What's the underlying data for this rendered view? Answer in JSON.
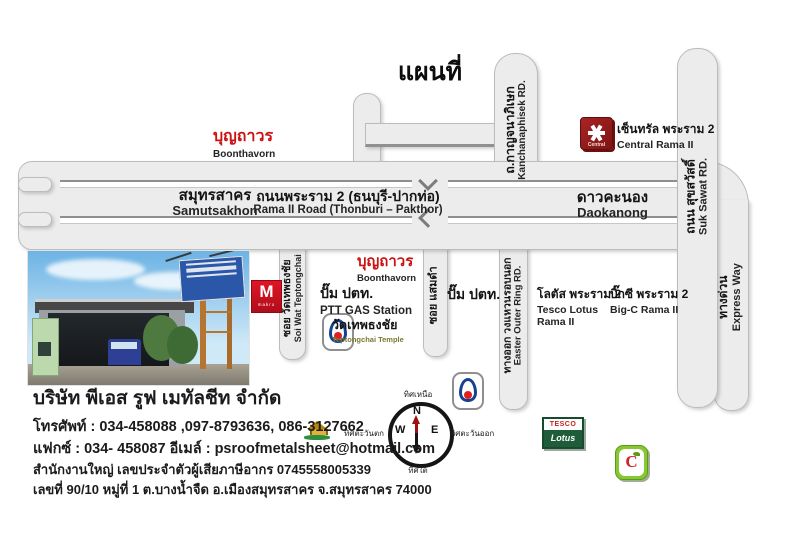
{
  "title": "แผนที่",
  "roads": {
    "samutsakhon_th": "สมุทรสาคร",
    "samutsakhon_en": "Samutsakhon",
    "rama2_th": "ถนนพระราม 2 (ธนบุรี-ปากท่อ)",
    "rama2_en": "Rama II Road (Thonburi – Pakthor)",
    "daokanong_th": "ดาวคะนอง",
    "daokanong_en": "Daokanong",
    "kanchanaphisek_th": "ถ.กาญจนาภิเษก",
    "kanchanaphisek_en": "Kanchanaphisek RD.",
    "suksawat_th": "ถนน สุขสวัสดิ์",
    "suksawat_en": "Suk Sawat RD.",
    "expressway_th": "ทางด่วน",
    "expressway_en": "Express Way",
    "outerring_th": "ทางออก วงแหวนรอบนอก",
    "outerring_en": "Easter Outer Ring RD.",
    "soi_wat_th": "ซอย วัดเทพธงชัย",
    "soi_wat_en": "Soi Wat Teptongchai",
    "soi_samaedam_th": "ซอย แสมดำ"
  },
  "pois": {
    "boonthavorn_top_th": "บุญถาวร",
    "boonthavorn_top_en": "Boonthavorn",
    "central_th": "เซ็นทรัล พระราม 2",
    "central_en": "Central Rama II",
    "central_logo": "Central",
    "makro_m": "M",
    "makro_word": "makro",
    "boonthavorn_mid_th": "บุญถาวร",
    "boonthavorn_mid_en": "Boonthavorn",
    "ptt1_th": "ปั๊ม ปตท.",
    "ptt1_en": "PTT GAS Station",
    "ptt2_th": "ปั๊ม ปตท.",
    "temple_th": "วัดเทพธงชัย",
    "temple_en": "Teptongchai Temple",
    "tesco_logo_top": "TESCO",
    "tesco_logo_bottom": "Lotus",
    "tesco_th": "โลตัส พระราม 2",
    "tesco_en1": "Tesco Lotus",
    "tesco_en2": "Rama II",
    "bigc_c": "C",
    "bigc_th": "บิ๊กซี พระราม 2",
    "bigc_en": "Big-C Rama II"
  },
  "compass": {
    "n": "N",
    "s": "S",
    "e": "E",
    "w": "W",
    "north_th": "ทิศเหนือ",
    "south_th": "ทิศใต้",
    "east_th": "ทิศตะวันออก",
    "west_th": "ทิศตะวันตก"
  },
  "company": {
    "name": "บริษัท พีเอส รูฟ เมทัลชีท จำกัด",
    "phone": "โทรศัพท์ : 034-458088 ,097-8793636, 086-3127662",
    "fax_email": "แฟกซ์ : 034- 458087   อีเมล์ : psroofmetalsheet@hotmail.com",
    "tax": "สำนักงานใหญ่ เลขประจำตัวผู้เสียภาษีอากร 0745558005339",
    "address": "เลขที่ 90/10 หมู่ที่ 1 ต.บางน้ำจืด อ.เมืองสมุทรสาคร จ.สมุทรสาคร 74000"
  },
  "colors": {
    "road_fill": "#ececec",
    "road_border": "#bcbcbc",
    "median_dark": "#8f8f8f",
    "accent_red": "#cc1111",
    "ptt_blue": "#16418f",
    "ptt_red": "#e02020",
    "central_red": "#9b1c1c",
    "makro_red": "#cf1020",
    "tesco_green": "#1e5c3a",
    "bigc_green": "#86c832",
    "bigc_red": "#d42027",
    "compass_red": "#a01010"
  }
}
